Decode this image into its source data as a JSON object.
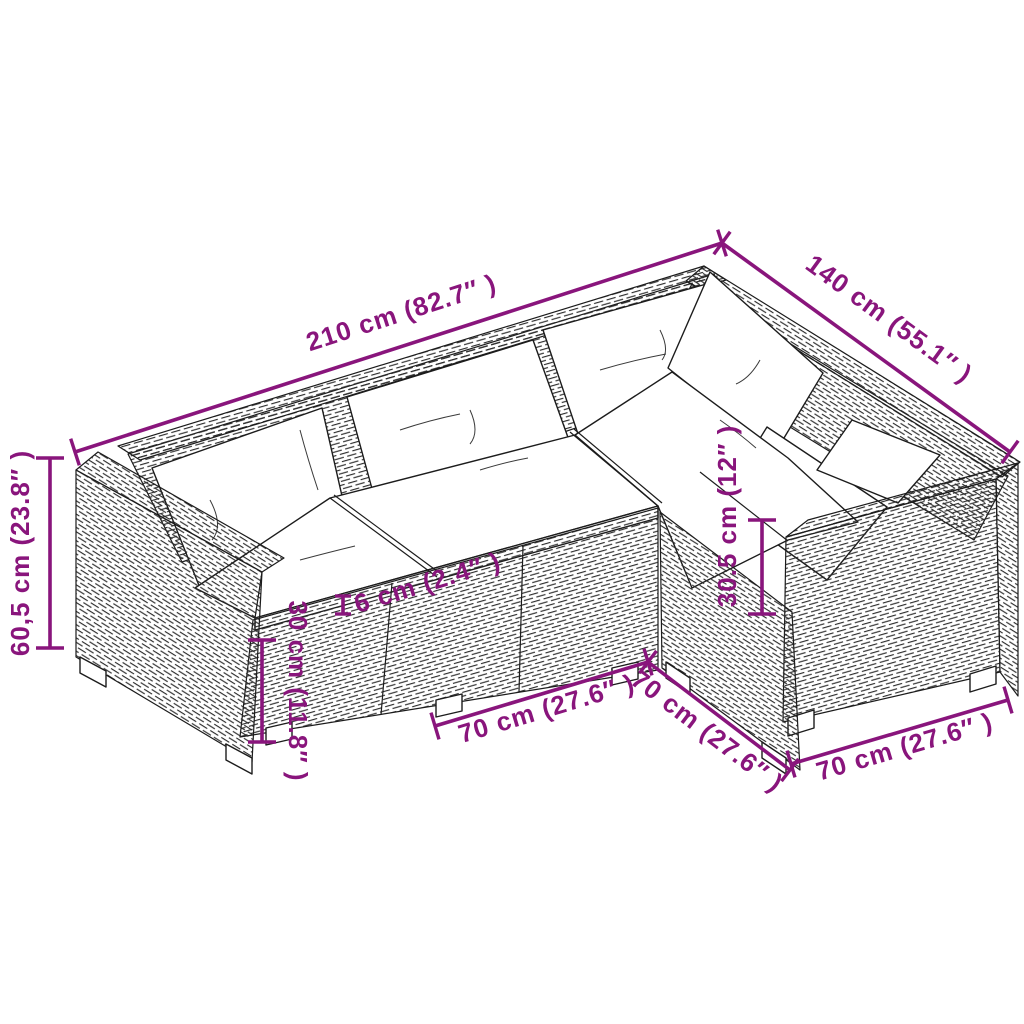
{
  "page": {
    "background": "#ffffff"
  },
  "diagram": {
    "description": "Isometric line-art drawing of an L-shaped poly rattan garden lounge sofa set with white cushions, annotated with product dimensions",
    "accent_color": "#89157C",
    "outline_color": "#1c1c1c",
    "dimensions": [
      {
        "id": "back-total-width",
        "label": "210 cm (82.7″ )",
        "cm": "210",
        "inches": "82.7"
      },
      {
        "id": "side-total-depth",
        "label": "140 cm (55.1″ )",
        "cm": "140",
        "inches": "55.1"
      },
      {
        "id": "overall-height",
        "label": "60,5 cm (23.8″ )",
        "cm": "60,5",
        "inches": "23.8"
      },
      {
        "id": "base-height",
        "label": "30 cm (11.8″ )",
        "cm": "30",
        "inches": "11.8"
      },
      {
        "id": "seat-cushion-thickness",
        "label": "6 cm (2.4″ )",
        "cm": "6",
        "inches": "2.4"
      },
      {
        "id": "backrest-height",
        "label": "30.5 cm (12″ )",
        "cm": "30.5",
        "inches": "12"
      },
      {
        "id": "seat-module-width",
        "label": "70 cm (27.6″ )",
        "cm": "70",
        "inches": "27.6"
      },
      {
        "id": "corner-module-depth",
        "label": "70 cm (27.6″ )",
        "cm": "70",
        "inches": "27.6"
      },
      {
        "id": "end-module-width",
        "label": "70 cm (27.6″ )",
        "cm": "70",
        "inches": "27.6"
      }
    ]
  }
}
